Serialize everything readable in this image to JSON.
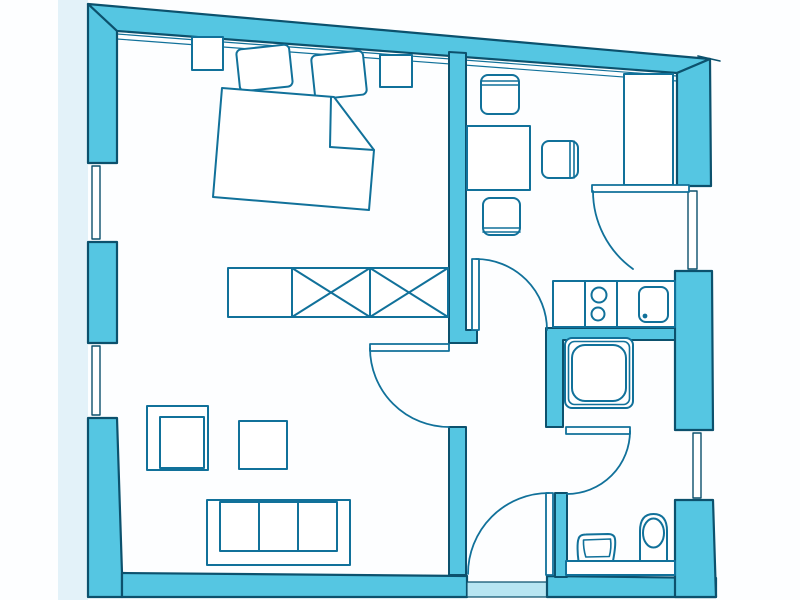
{
  "meta": {
    "description": "scanned-apartment-floor-plan",
    "canvas": {
      "width": 800,
      "height": 600
    },
    "background": "#fdfeff"
  },
  "palette": {
    "wall": "#55c6e2",
    "wallLine": "#0c516d",
    "furn": "#11719a",
    "white": "#ffffff",
    "threshold": "#b7e5f2",
    "pageTint": "#e3f2f9"
  },
  "shapes": [
    {
      "name": "scan-margin-tint",
      "type": "rect",
      "x": 58,
      "y": 0,
      "w": 30,
      "h": 600,
      "fill": "pageTint"
    },
    {
      "name": "top-wall",
      "type": "polygon",
      "pts": "88,4 710,59 677,73 117,31",
      "fill": "wall",
      "stroke": "wallLine",
      "sw": 2.2
    },
    {
      "name": "top-wall-overshoot-line",
      "type": "line",
      "x1": 698,
      "y1": 56,
      "x2": 720,
      "y2": 61,
      "stroke": "wallLine",
      "sw": 1.6
    },
    {
      "name": "top-wall-trim-line-upper",
      "type": "line",
      "x1": 117,
      "y1": 34,
      "x2": 677,
      "y2": 76,
      "stroke": "furn",
      "sw": 1.2
    },
    {
      "name": "top-wall-trim-line-lower",
      "type": "line",
      "x1": 117,
      "y1": 39,
      "x2": 677,
      "y2": 81,
      "stroke": "furn",
      "sw": 1.2
    },
    {
      "name": "left-wall-upper",
      "type": "polygon",
      "pts": "88,4 117,31 117,163 88,163",
      "fill": "wall",
      "stroke": "wallLine",
      "sw": 2.2
    },
    {
      "name": "window-left-upper-reveal-top",
      "type": "line",
      "x1": 88,
      "y1": 163,
      "x2": 117,
      "y2": 163,
      "stroke": "wallLine",
      "sw": 1.5
    },
    {
      "name": "window-left-upper-reveal-bottom",
      "type": "line",
      "x1": 88,
      "y1": 242,
      "x2": 117,
      "y2": 242,
      "stroke": "wallLine",
      "sw": 1.5
    },
    {
      "name": "window-left-upper-glazing",
      "type": "rect",
      "x": 92,
      "y": 166,
      "w": 8,
      "h": 73,
      "fill": "white",
      "stroke": "wallLine",
      "sw": 1.4
    },
    {
      "name": "left-wall-mid",
      "type": "rect",
      "x": 88,
      "y": 242,
      "w": 29,
      "h": 101,
      "fill": "wall",
      "stroke": "wallLine",
      "sw": 2.2
    },
    {
      "name": "window-left-lower-reveal-top",
      "type": "line",
      "x1": 88,
      "y1": 343,
      "x2": 117,
      "y2": 343,
      "stroke": "wallLine",
      "sw": 1.5
    },
    {
      "name": "window-left-lower-reveal-bottom",
      "type": "line",
      "x1": 88,
      "y1": 418,
      "x2": 117,
      "y2": 418,
      "stroke": "wallLine",
      "sw": 1.5
    },
    {
      "name": "window-left-lower-glazing",
      "type": "rect",
      "x": 92,
      "y": 346,
      "w": 8,
      "h": 69,
      "fill": "white",
      "stroke": "wallLine",
      "sw": 1.4
    },
    {
      "name": "left-wall-lower",
      "type": "polygon",
      "pts": "88,418 117,418 122,573 122,597 88,597",
      "fill": "wall",
      "stroke": "wallLine",
      "sw": 2.2
    },
    {
      "name": "bottom-wall-left",
      "type": "polygon",
      "pts": "122,573 467,576 467,597 122,597",
      "fill": "wall",
      "stroke": "wallLine",
      "sw": 2.2
    },
    {
      "name": "entrance-threshold",
      "type": "rect",
      "x": 467,
      "y": 582,
      "w": 80,
      "h": 15,
      "fill": "threshold",
      "stroke": "wallLine",
      "sw": 1.2
    },
    {
      "name": "bottom-wall-right",
      "type": "polygon",
      "pts": "547,576 716,578 716,597 547,597",
      "fill": "wall",
      "stroke": "wallLine",
      "sw": 2.2
    },
    {
      "name": "right-wall-upper",
      "type": "polygon",
      "pts": "677,73 710,59 711,186 677,186",
      "fill": "wall",
      "stroke": "wallLine",
      "sw": 2.2
    },
    {
      "name": "balcony-door-reveal-top",
      "type": "line",
      "x1": 677,
      "y1": 186,
      "x2": 711,
      "y2": 186,
      "stroke": "wallLine",
      "sw": 1.5
    },
    {
      "name": "balcony-door-reveal-bottom",
      "type": "line",
      "x1": 677,
      "y1": 271,
      "x2": 712,
      "y2": 271,
      "stroke": "wallLine",
      "sw": 1.5
    },
    {
      "name": "balcony-door-glazing",
      "type": "rect",
      "x": 688,
      "y": 191,
      "w": 9,
      "h": 78,
      "fill": "white",
      "stroke": "wallLine",
      "sw": 1.4
    },
    {
      "name": "right-wall-mid",
      "type": "polygon",
      "pts": "675,271 712,271 713,430 675,430",
      "fill": "wall",
      "stroke": "wallLine",
      "sw": 2.2
    },
    {
      "name": "window-right-reveal-top",
      "type": "line",
      "x1": 675,
      "y1": 430,
      "x2": 713,
      "y2": 430,
      "stroke": "wallLine",
      "sw": 1.5
    },
    {
      "name": "window-right-reveal-bottom",
      "type": "line",
      "x1": 675,
      "y1": 500,
      "x2": 713,
      "y2": 500,
      "stroke": "wallLine",
      "sw": 1.5
    },
    {
      "name": "window-right-glazing",
      "type": "rect",
      "x": 693,
      "y": 433,
      "w": 8,
      "h": 65,
      "fill": "white",
      "stroke": "wallLine",
      "sw": 1.4
    },
    {
      "name": "right-wall-lower",
      "type": "polygon",
      "pts": "675,500 713,500 716,597 675,597",
      "fill": "wall",
      "stroke": "wallLine",
      "sw": 2.2
    },
    {
      "name": "wall-bedroom-hall",
      "type": "polygon",
      "pts": "449,52 466,53 466,330 477,330 477,343 449,343",
      "fill": "wall",
      "stroke": "wallLine",
      "sw": 2
    },
    {
      "name": "wall-kitchen-shower",
      "type": "polygon",
      "pts": "546,328 675,328 675,340 563,340 563,427 546,427",
      "fill": "wall",
      "stroke": "wallLine",
      "sw": 2
    },
    {
      "name": "wall-living-hall",
      "type": "rect",
      "x": 449,
      "y": 427,
      "w": 17,
      "h": 148,
      "fill": "wall",
      "stroke": "wallLine",
      "sw": 2
    },
    {
      "name": "wall-hall-bathroom",
      "type": "rect",
      "x": 555,
      "y": 493,
      "w": 12,
      "h": 84,
      "fill": "wall",
      "stroke": "wallLine",
      "sw": 2
    },
    {
      "name": "nightstand-left",
      "type": "rect",
      "x": 192,
      "y": 37,
      "w": 31,
      "h": 33,
      "fill": "white",
      "stroke": "furn",
      "sw": 2
    },
    {
      "name": "nightstand-right",
      "type": "rect",
      "x": 380,
      "y": 55,
      "w": 32,
      "h": 32,
      "fill": "white",
      "stroke": "furn",
      "sw": 2
    },
    {
      "name": "bed-pillow-left",
      "type": "rect",
      "x": 238,
      "y": 47,
      "w": 53,
      "h": 42,
      "rx": 5,
      "fill": "white",
      "stroke": "furn",
      "sw": 2,
      "transform": "rotate(-6 264 68)"
    },
    {
      "name": "bed-pillow-right",
      "type": "rect",
      "x": 313,
      "y": 53,
      "w": 52,
      "h": 44,
      "rx": 5,
      "fill": "white",
      "stroke": "furn",
      "sw": 2,
      "transform": "rotate(-6 339 75)"
    },
    {
      "name": "bed-outline",
      "type": "path",
      "d": "M222 88 L334 97 L374 150 L369 210 L213 197 Z",
      "fill": "white",
      "stroke": "furn",
      "sw": 2
    },
    {
      "name": "bed-blanket-fold-vertical-line",
      "type": "line",
      "x1": 331,
      "y1": 97,
      "x2": 330,
      "y2": 147,
      "stroke": "furn",
      "sw": 2
    },
    {
      "name": "bed-blanket-fold-horizontal-line",
      "type": "line",
      "x1": 330,
      "y1": 147,
      "x2": 374,
      "y2": 150,
      "stroke": "furn",
      "sw": 2
    },
    {
      "name": "wardrobe",
      "type": "rect",
      "x": 228,
      "y": 268,
      "w": 220,
      "h": 49,
      "fill": "white",
      "stroke": "furn",
      "sw": 2
    },
    {
      "name": "wardrobe-divider-1",
      "type": "line",
      "x1": 292,
      "y1": 268,
      "x2": 292,
      "y2": 317,
      "stroke": "furn",
      "sw": 2
    },
    {
      "name": "wardrobe-divider-2",
      "type": "line",
      "x1": 370,
      "y1": 268,
      "x2": 370,
      "y2": 317,
      "stroke": "furn",
      "sw": 2
    },
    {
      "name": "wardrobe-cross-1a",
      "type": "line",
      "x1": 292,
      "y1": 268,
      "x2": 370,
      "y2": 317,
      "stroke": "furn",
      "sw": 2
    },
    {
      "name": "wardrobe-cross-1b",
      "type": "line",
      "x1": 292,
      "y1": 317,
      "x2": 370,
      "y2": 268,
      "stroke": "furn",
      "sw": 2
    },
    {
      "name": "wardrobe-cross-2a",
      "type": "line",
      "x1": 370,
      "y1": 268,
      "x2": 448,
      "y2": 317,
      "stroke": "furn",
      "sw": 2
    },
    {
      "name": "wardrobe-cross-2b",
      "type": "line",
      "x1": 370,
      "y1": 317,
      "x2": 448,
      "y2": 268,
      "stroke": "furn",
      "sw": 2
    },
    {
      "name": "armchair-outer",
      "type": "rect",
      "x": 147,
      "y": 406,
      "w": 61,
      "h": 64,
      "fill": "white",
      "stroke": "furn",
      "sw": 2
    },
    {
      "name": "armchair-seat",
      "type": "rect",
      "x": 160,
      "y": 417,
      "w": 44,
      "h": 51,
      "fill": "white",
      "stroke": "furn",
      "sw": 2
    },
    {
      "name": "coffee-table",
      "type": "rect",
      "x": 239,
      "y": 421,
      "w": 48,
      "h": 48,
      "fill": "white",
      "stroke": "furn",
      "sw": 2
    },
    {
      "name": "sofa-outline",
      "type": "rect",
      "x": 207,
      "y": 500,
      "w": 143,
      "h": 65,
      "fill": "white",
      "stroke": "furn",
      "sw": 2
    },
    {
      "name": "sofa-seat",
      "type": "rect",
      "x": 220,
      "y": 502,
      "w": 117,
      "h": 49,
      "fill": "white",
      "stroke": "furn",
      "sw": 2
    },
    {
      "name": "sofa-cushion-divider-1",
      "type": "line",
      "x1": 259,
      "y1": 502,
      "x2": 259,
      "y2": 551,
      "stroke": "furn",
      "sw": 2
    },
    {
      "name": "sofa-cushion-divider-2",
      "type": "line",
      "x1": 298,
      "y1": 502,
      "x2": 298,
      "y2": 551,
      "stroke": "furn",
      "sw": 2
    },
    {
      "name": "dining-table",
      "type": "rect",
      "x": 467,
      "y": 126,
      "w": 63,
      "h": 64,
      "fill": "white",
      "stroke": "furn",
      "sw": 2
    },
    {
      "name": "chair-north",
      "type": "rect",
      "x": 481,
      "y": 75,
      "w": 38,
      "h": 39,
      "rx": 7,
      "fill": "white",
      "stroke": "furn",
      "sw": 2
    },
    {
      "name": "chair-north-backrest-line-1",
      "type": "line",
      "x1": 481,
      "y1": 81,
      "x2": 519,
      "y2": 81,
      "stroke": "furn",
      "sw": 1.6
    },
    {
      "name": "chair-north-backrest-line-2",
      "type": "line",
      "x1": 481,
      "y1": 85,
      "x2": 519,
      "y2": 85,
      "stroke": "furn",
      "sw": 1.6
    },
    {
      "name": "chair-east",
      "type": "rect",
      "x": 542,
      "y": 141,
      "w": 36,
      "h": 37,
      "rx": 7,
      "fill": "white",
      "stroke": "furn",
      "sw": 2
    },
    {
      "name": "chair-east-backrest-line-1",
      "type": "line",
      "x1": 570,
      "y1": 141,
      "x2": 570,
      "y2": 178,
      "stroke": "furn",
      "sw": 1.6
    },
    {
      "name": "chair-east-backrest-line-2",
      "type": "line",
      "x1": 574,
      "y1": 141,
      "x2": 574,
      "y2": 178,
      "stroke": "furn",
      "sw": 1.6
    },
    {
      "name": "chair-south",
      "type": "rect",
      "x": 483,
      "y": 198,
      "w": 37,
      "h": 37,
      "rx": 7,
      "fill": "white",
      "stroke": "furn",
      "sw": 2
    },
    {
      "name": "chair-south-backrest-line-1",
      "type": "line",
      "x1": 483,
      "y1": 228,
      "x2": 520,
      "y2": 228,
      "stroke": "furn",
      "sw": 1.6
    },
    {
      "name": "chair-south-backrest-line-2",
      "type": "line",
      "x1": 483,
      "y1": 232,
      "x2": 520,
      "y2": 232,
      "stroke": "furn",
      "sw": 1.6
    },
    {
      "name": "tall-cupboard",
      "type": "rect",
      "x": 624,
      "y": 74,
      "w": 49,
      "h": 111,
      "fill": "white",
      "stroke": "furn",
      "sw": 2
    },
    {
      "name": "kitchen-counter",
      "type": "rect",
      "x": 553,
      "y": 281,
      "w": 122,
      "h": 46,
      "fill": "white",
      "stroke": "furn",
      "sw": 2
    },
    {
      "name": "kitchen-counter-divider-1",
      "type": "line",
      "x1": 585,
      "y1": 281,
      "x2": 585,
      "y2": 327,
      "stroke": "furn",
      "sw": 2
    },
    {
      "name": "kitchen-counter-divider-2",
      "type": "line",
      "x1": 617,
      "y1": 281,
      "x2": 617,
      "y2": 327,
      "stroke": "furn",
      "sw": 2
    },
    {
      "name": "cooktop-burner-1",
      "type": "circle",
      "cx": 599,
      "cy": 295,
      "r": 7.5,
      "fill": "white",
      "stroke": "furn",
      "sw": 2
    },
    {
      "name": "cooktop-burner-2",
      "type": "circle",
      "cx": 598,
      "cy": 314,
      "r": 6.5,
      "fill": "white",
      "stroke": "furn",
      "sw": 2
    },
    {
      "name": "kitchen-sink",
      "type": "rect",
      "x": 639,
      "y": 287,
      "w": 29,
      "h": 35,
      "rx": 7,
      "fill": "white",
      "stroke": "furn",
      "sw": 2
    },
    {
      "name": "kitchen-sink-drain-dot",
      "type": "circle",
      "cx": 645,
      "cy": 316,
      "r": 2.4,
      "fill": "furn"
    },
    {
      "name": "shower-outer",
      "type": "rect",
      "x": 565,
      "y": 338,
      "w": 68,
      "h": 70,
      "rx": 7,
      "fill": "white",
      "stroke": "furn",
      "sw": 2
    },
    {
      "name": "shower-mid",
      "type": "rect",
      "x": 568.5,
      "y": 341.5,
      "w": 61,
      "h": 63,
      "rx": 6,
      "fill": "none",
      "stroke": "furn",
      "sw": 1.6
    },
    {
      "name": "shower-floor",
      "type": "rect",
      "x": 572,
      "y": 345,
      "w": 54,
      "h": 56,
      "rx": 13,
      "fill": "white",
      "stroke": "furn",
      "sw": 2
    },
    {
      "name": "bathroom-shelf",
      "type": "rect",
      "x": 566,
      "y": 561,
      "w": 109,
      "h": 14,
      "fill": "white",
      "stroke": "furn",
      "sw": 2
    },
    {
      "name": "toilet-pedestal",
      "type": "path",
      "d": "M640 561 L640 531 Q640 514 653.5 514 Q667 514 667 531 L667 561 Z",
      "fill": "white",
      "stroke": "furn",
      "sw": 2
    },
    {
      "name": "toilet-bowl",
      "type": "ellipse",
      "cx": 653.5,
      "cy": 533,
      "rx": 10.5,
      "ry": 14.5,
      "fill": "white",
      "stroke": "furn",
      "sw": 2
    },
    {
      "name": "bidet-outer",
      "type": "path",
      "d": "M578.5 561 C577.5 554 577 543 578.5 539 C579.2 535.5 582 534.5 586 534.5 L608 534 C612 534 614.5 535.5 615 539 C615.8 544 614.5 553 613 561 Z",
      "fill": "white",
      "stroke": "furn",
      "sw": 2
    },
    {
      "name": "bidet-inner",
      "type": "path",
      "d": "M583.5 540 L610.5 539 C611.3 545 610.8 551 609.3 556.5 L585.8 557 C584 551 583.3 545 583.5 540 Z",
      "fill": "none",
      "stroke": "furn",
      "sw": 1.6
    },
    {
      "name": "living-room-door-leaf",
      "type": "rect",
      "x": 370,
      "y": 344,
      "w": 79,
      "h": 7,
      "fill": "white",
      "stroke": "furn",
      "sw": 1.8
    },
    {
      "name": "living-room-door-swing-arc",
      "type": "path",
      "d": "M370 348 A79 79 0 0 0 449 427",
      "fill": "none",
      "stroke": "furn",
      "sw": 1.8
    },
    {
      "name": "kitchen-door-leaf",
      "type": "rect",
      "x": 472,
      "y": 259,
      "w": 7,
      "h": 71,
      "fill": "white",
      "stroke": "furn",
      "sw": 1.8
    },
    {
      "name": "kitchen-door-swing-arc",
      "type": "path",
      "d": "M476 259 A71 71 0 0 1 547 330",
      "fill": "none",
      "stroke": "furn",
      "sw": 1.8
    },
    {
      "name": "balcony-door-leaf",
      "type": "rect",
      "x": 592,
      "y": 185,
      "w": 97,
      "h": 7,
      "fill": "white",
      "stroke": "furn",
      "sw": 1.8
    },
    {
      "name": "balcony-door-swing-arc",
      "type": "path",
      "d": "M593 191 A96 96 0 0 0 633 269",
      "fill": "none",
      "stroke": "furn",
      "sw": 1.8
    },
    {
      "name": "bathroom-door-leaf",
      "type": "rect",
      "x": 566,
      "y": 427,
      "w": 64,
      "h": 7,
      "fill": "white",
      "stroke": "furn",
      "sw": 1.8
    },
    {
      "name": "bathroom-door-swing-arc",
      "type": "path",
      "d": "M630 431 A63 63 0 0 1 567 494",
      "fill": "none",
      "stroke": "furn",
      "sw": 1.8
    },
    {
      "name": "entrance-door-leaf",
      "type": "rect",
      "x": 546,
      "y": 493,
      "w": 7,
      "h": 82,
      "fill": "white",
      "stroke": "furn",
      "sw": 1.8
    },
    {
      "name": "entrance-door-swing-arc",
      "type": "path",
      "d": "M549 493 A81 81 0 0 0 468 574",
      "fill": "none",
      "stroke": "furn",
      "sw": 1.8
    }
  ]
}
